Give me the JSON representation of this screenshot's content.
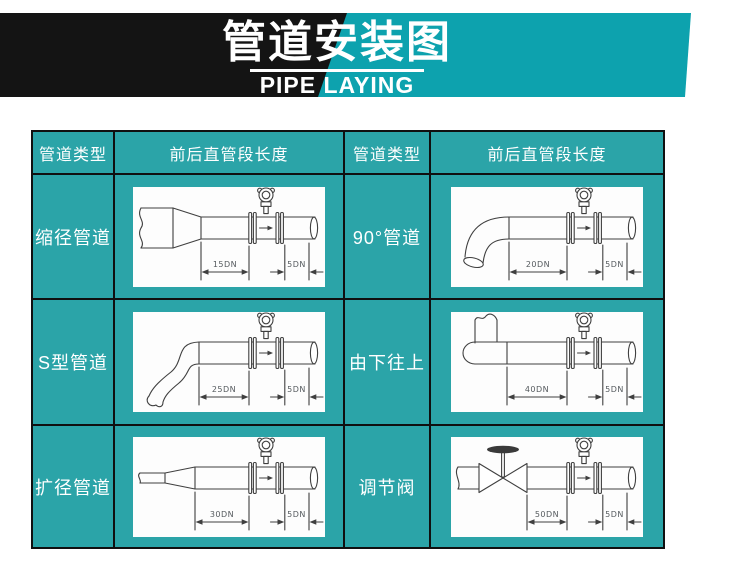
{
  "banner": {
    "title": "管道安装图",
    "subtitle": "PIPE LAYING"
  },
  "table": {
    "headers": [
      "管道类型",
      "前后直管段长度",
      "管道类型",
      "前后直管段长度"
    ],
    "rows": [
      {
        "left": {
          "type": "缩径管道",
          "diagram": "reducing-pipe",
          "upstream": "15DN",
          "downstream": "5DN"
        },
        "right": {
          "type": "90°管道",
          "diagram": "elbow-90-pipe",
          "upstream": "20DN",
          "downstream": "5DN"
        }
      },
      {
        "left": {
          "type": "S型管道",
          "diagram": "s-shaped-pipe",
          "upstream": "25DN",
          "downstream": "5DN"
        },
        "right": {
          "type": "由下往上",
          "diagram": "bottom-to-top-pipe",
          "upstream": "40DN",
          "downstream": "5DN"
        }
      },
      {
        "left": {
          "type": "扩径管道",
          "diagram": "expanding-pipe",
          "upstream": "30DN",
          "downstream": "5DN"
        },
        "right": {
          "type": "调节阀",
          "diagram": "control-valve-pipe",
          "upstream": "50DN",
          "downstream": "5DN"
        }
      }
    ]
  },
  "colors": {
    "banner_teal": "#0da2ae",
    "banner_black": "#141414",
    "cell_teal": "#2ba4a8",
    "grid_black": "#101010",
    "diagram_line": "#3f3f3f",
    "dimension_text": "#555a5e",
    "text_white": "#ffffff"
  }
}
